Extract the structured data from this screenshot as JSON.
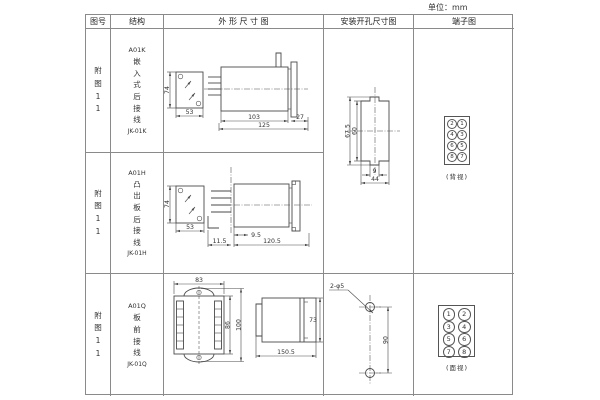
{
  "unit_note": "单位：mm",
  "header": {
    "figure": "图号",
    "structure": "结构",
    "outline": "外 形 尺 寸 图",
    "mounting": "安装开孔尺寸图",
    "terminal": "端子图"
  },
  "rows": [
    {
      "figure": "附图11",
      "model": "A01K",
      "structure": "嵌入式后接线",
      "code": "JK-01K",
      "dims": {
        "front_h": "74",
        "front_w": "53",
        "body": "103",
        "flange": "27",
        "total": "125"
      }
    },
    {
      "figure": "附图11",
      "model": "A01H",
      "structure": "凸出板后接线",
      "code": "JK-01H",
      "dims": {
        "front_h": "74",
        "front_w": "53",
        "offset": "9.5",
        "total": "120.5",
        "left": "11.5"
      }
    },
    {
      "figure": "附图11",
      "model": "A01Q",
      "structure": "板前接线",
      "code": "JK-01Q",
      "dims": {
        "front_w": "83",
        "inner_h": "86",
        "outer_h": "100",
        "side_h": "73",
        "depth": "150.5"
      }
    }
  ],
  "cutout_dims": {
    "outer_h": "67.5",
    "inner_h": "60",
    "notch_w": "9",
    "width": "44"
  },
  "mounting3": {
    "callout": "2-φ5",
    "spacing": "90"
  },
  "terminal_back": {
    "cells": [
      "2",
      "1",
      "4",
      "3",
      "6",
      "5",
      "8",
      "7"
    ],
    "label": "(背视)"
  },
  "terminal_front": {
    "cells": [
      "1",
      "2",
      "3",
      "4",
      "5",
      "6",
      "7",
      "8"
    ],
    "label": "(面视)"
  }
}
